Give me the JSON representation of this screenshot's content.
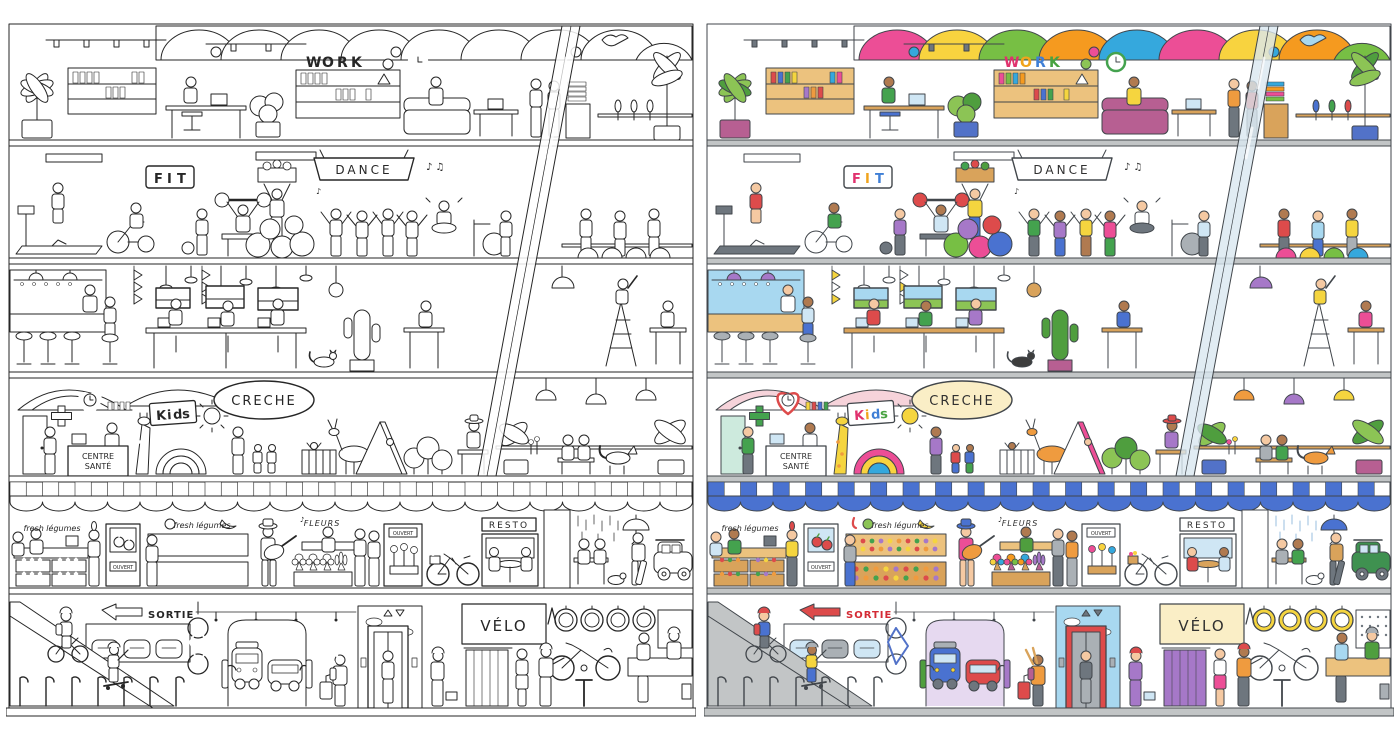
{
  "signs": {
    "work_letters": [
      "W",
      "O",
      "R",
      "K"
    ],
    "fit_letters": [
      "F",
      "I",
      "T"
    ],
    "dance": "DANCE",
    "music_note": "♪",
    "music_notes": "♪ ♫",
    "creche": "CRECHE",
    "kids_letters": [
      "K",
      "i",
      "d",
      "s"
    ],
    "centre_line1": "CENTRE",
    "centre_line2": "SANTÉ",
    "fresh_legumes": "fresh légumes",
    "ouvert": "OUVERT",
    "fleurs": "FLEURS",
    "resto": "RESTO",
    "sortie": "SORTIE",
    "velo": "VÉLO"
  },
  "colors": {
    "ink": "#41464b",
    "p-slab": "#c2c5c6",
    "p-wall": "#ffffff",
    "p-wallpink": "#f6d3da",
    "p-walllav": "#e6d9f0",
    "p-wallmint": "#cdeadd",
    "p-cream": "#faeec6",
    "p-glass": "#d9e7f0cc",
    "p-skyblue": "#a8d8f0",
    "p-ltblue": "#cfe6f4",
    "p-wood": "#ecc27e",
    "p-wood2": "#d9a35b",
    "p-plant": "#8cc455",
    "p-plant2": "#4f9e3e",
    "p-pot": "#b75f92",
    "p-pot2": "#5272c8",
    "p-red": "#dd4b4b",
    "p-orange": "#ef9b3f",
    "p-yellow": "#f5d53f",
    "p-green": "#44a24e",
    "p-blue": "#4a72d0",
    "p-purple": "#a678c8",
    "p-gray": "#aab0b5",
    "p-dgray": "#6e767e",
    "p-skin": "#f5c9a2",
    "p-skin2": "#b07a50",
    "p-cat": "#3d3d3d",
    "p-awn": "#4a72d0",
    "p-car": "#3f9150",
    "p-m1": "#ec4e96",
    "p-m2": "#f59a1f",
    "p-m3": "#f8d33f",
    "p-m4": "#77bf44",
    "p-m5": "#35a8dd",
    "t-ink": "#303030",
    "t-red": "#d42b35",
    "t-rain": "#8fb8dc",
    "t-c1": "#e0326e",
    "t-c2": "#f0a31c",
    "t-c3": "#3f7fd6",
    "t-c4": "#48a341"
  }
}
